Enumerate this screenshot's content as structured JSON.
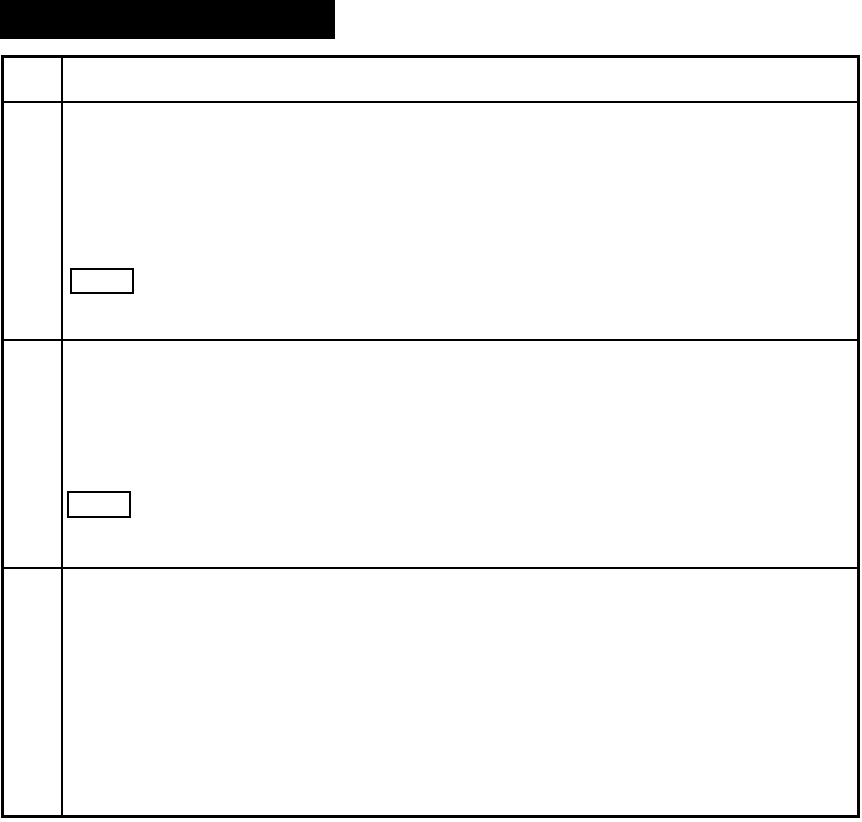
{
  "page": {
    "width_px": 862,
    "height_px": 822,
    "background_color": "#ffffff"
  },
  "redacted_title_block": {
    "description": "solid black filled rectangle covering the document title area",
    "color": "#000000"
  },
  "form_table": {
    "border_color": "#000000",
    "column_count": 2,
    "row_count": 4,
    "header_row": {
      "label_cell_text": "",
      "content_cell_text": ""
    },
    "rows": [
      {
        "label_cell_text": "",
        "content_cell_text": "",
        "has_entry_box": true
      },
      {
        "label_cell_text": "",
        "content_cell_text": "",
        "has_entry_box": true
      },
      {
        "label_cell_text": "",
        "content_cell_text": "",
        "has_entry_box": false
      }
    ],
    "entry_boxes": [
      {
        "value": "",
        "border_color": "#000000"
      },
      {
        "value": "",
        "border_color": "#000000"
      }
    ]
  }
}
